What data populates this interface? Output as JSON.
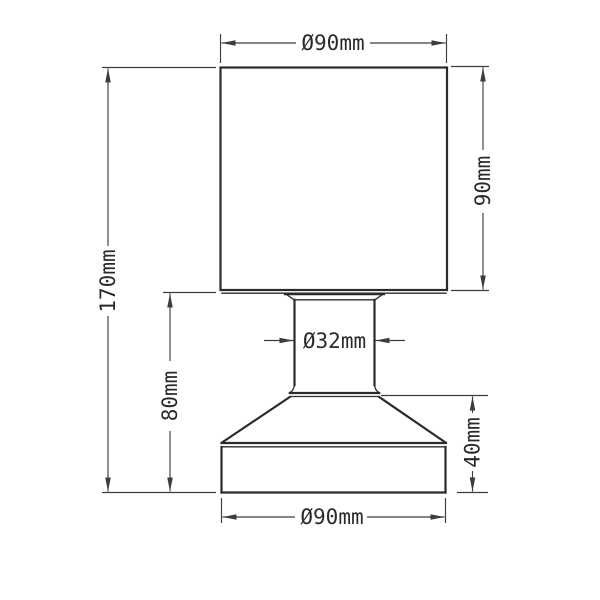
{
  "drawing": {
    "type": "technical-dimension-drawing",
    "subject": "table lamp with cylindrical shade and flared base",
    "background_color": "#ffffff",
    "object_line_color": "#2b2b2b",
    "dimension_line_color": "#3d3d3d",
    "text_color": "#2a2a2a",
    "unit": "mm",
    "labels": {
      "shade_diameter": "Ø90mm",
      "shade_height": "90mm",
      "total_height": "170mm",
      "neck_diameter": "Ø32mm",
      "lower_section_height": "80mm",
      "base_height": "40mm",
      "base_diameter": "Ø90mm"
    }
  }
}
